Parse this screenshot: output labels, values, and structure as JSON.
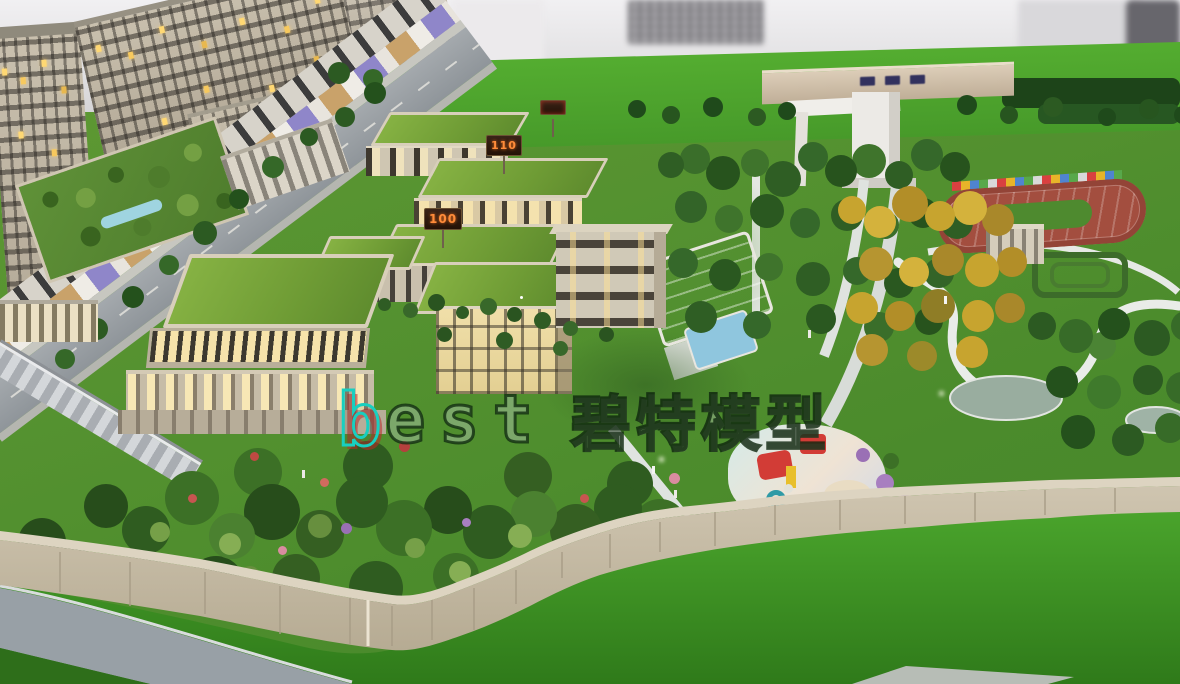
{
  "photo": {
    "subject": "architectural scale model of a kindergarten campus with residential towers, landscaped gardens and perimeter wall"
  },
  "watermark": {
    "latin_first": "b",
    "latin_rest": "est",
    "cjk": "碧特模型"
  },
  "signs": {
    "building_110": "110",
    "building_100": "100"
  },
  "colors": {
    "campus_lawn": "#559230",
    "outer_lawn": "#3f9629",
    "building_beige": "#c9c0ad",
    "roof_grass_green": "#7cab3e",
    "lit_window_warm": "#f4e2ae",
    "pool_water": "#8fc6de",
    "pond_water": "#99ad9f",
    "wall_beige": "#c5bba6",
    "road_gray": "#98a0a6",
    "track_red": "#a34e3f",
    "sign_digits_orange": "#ff8c3a",
    "watermark_cyan": "#18cfc0",
    "watermark_outline": "#10290f"
  }
}
